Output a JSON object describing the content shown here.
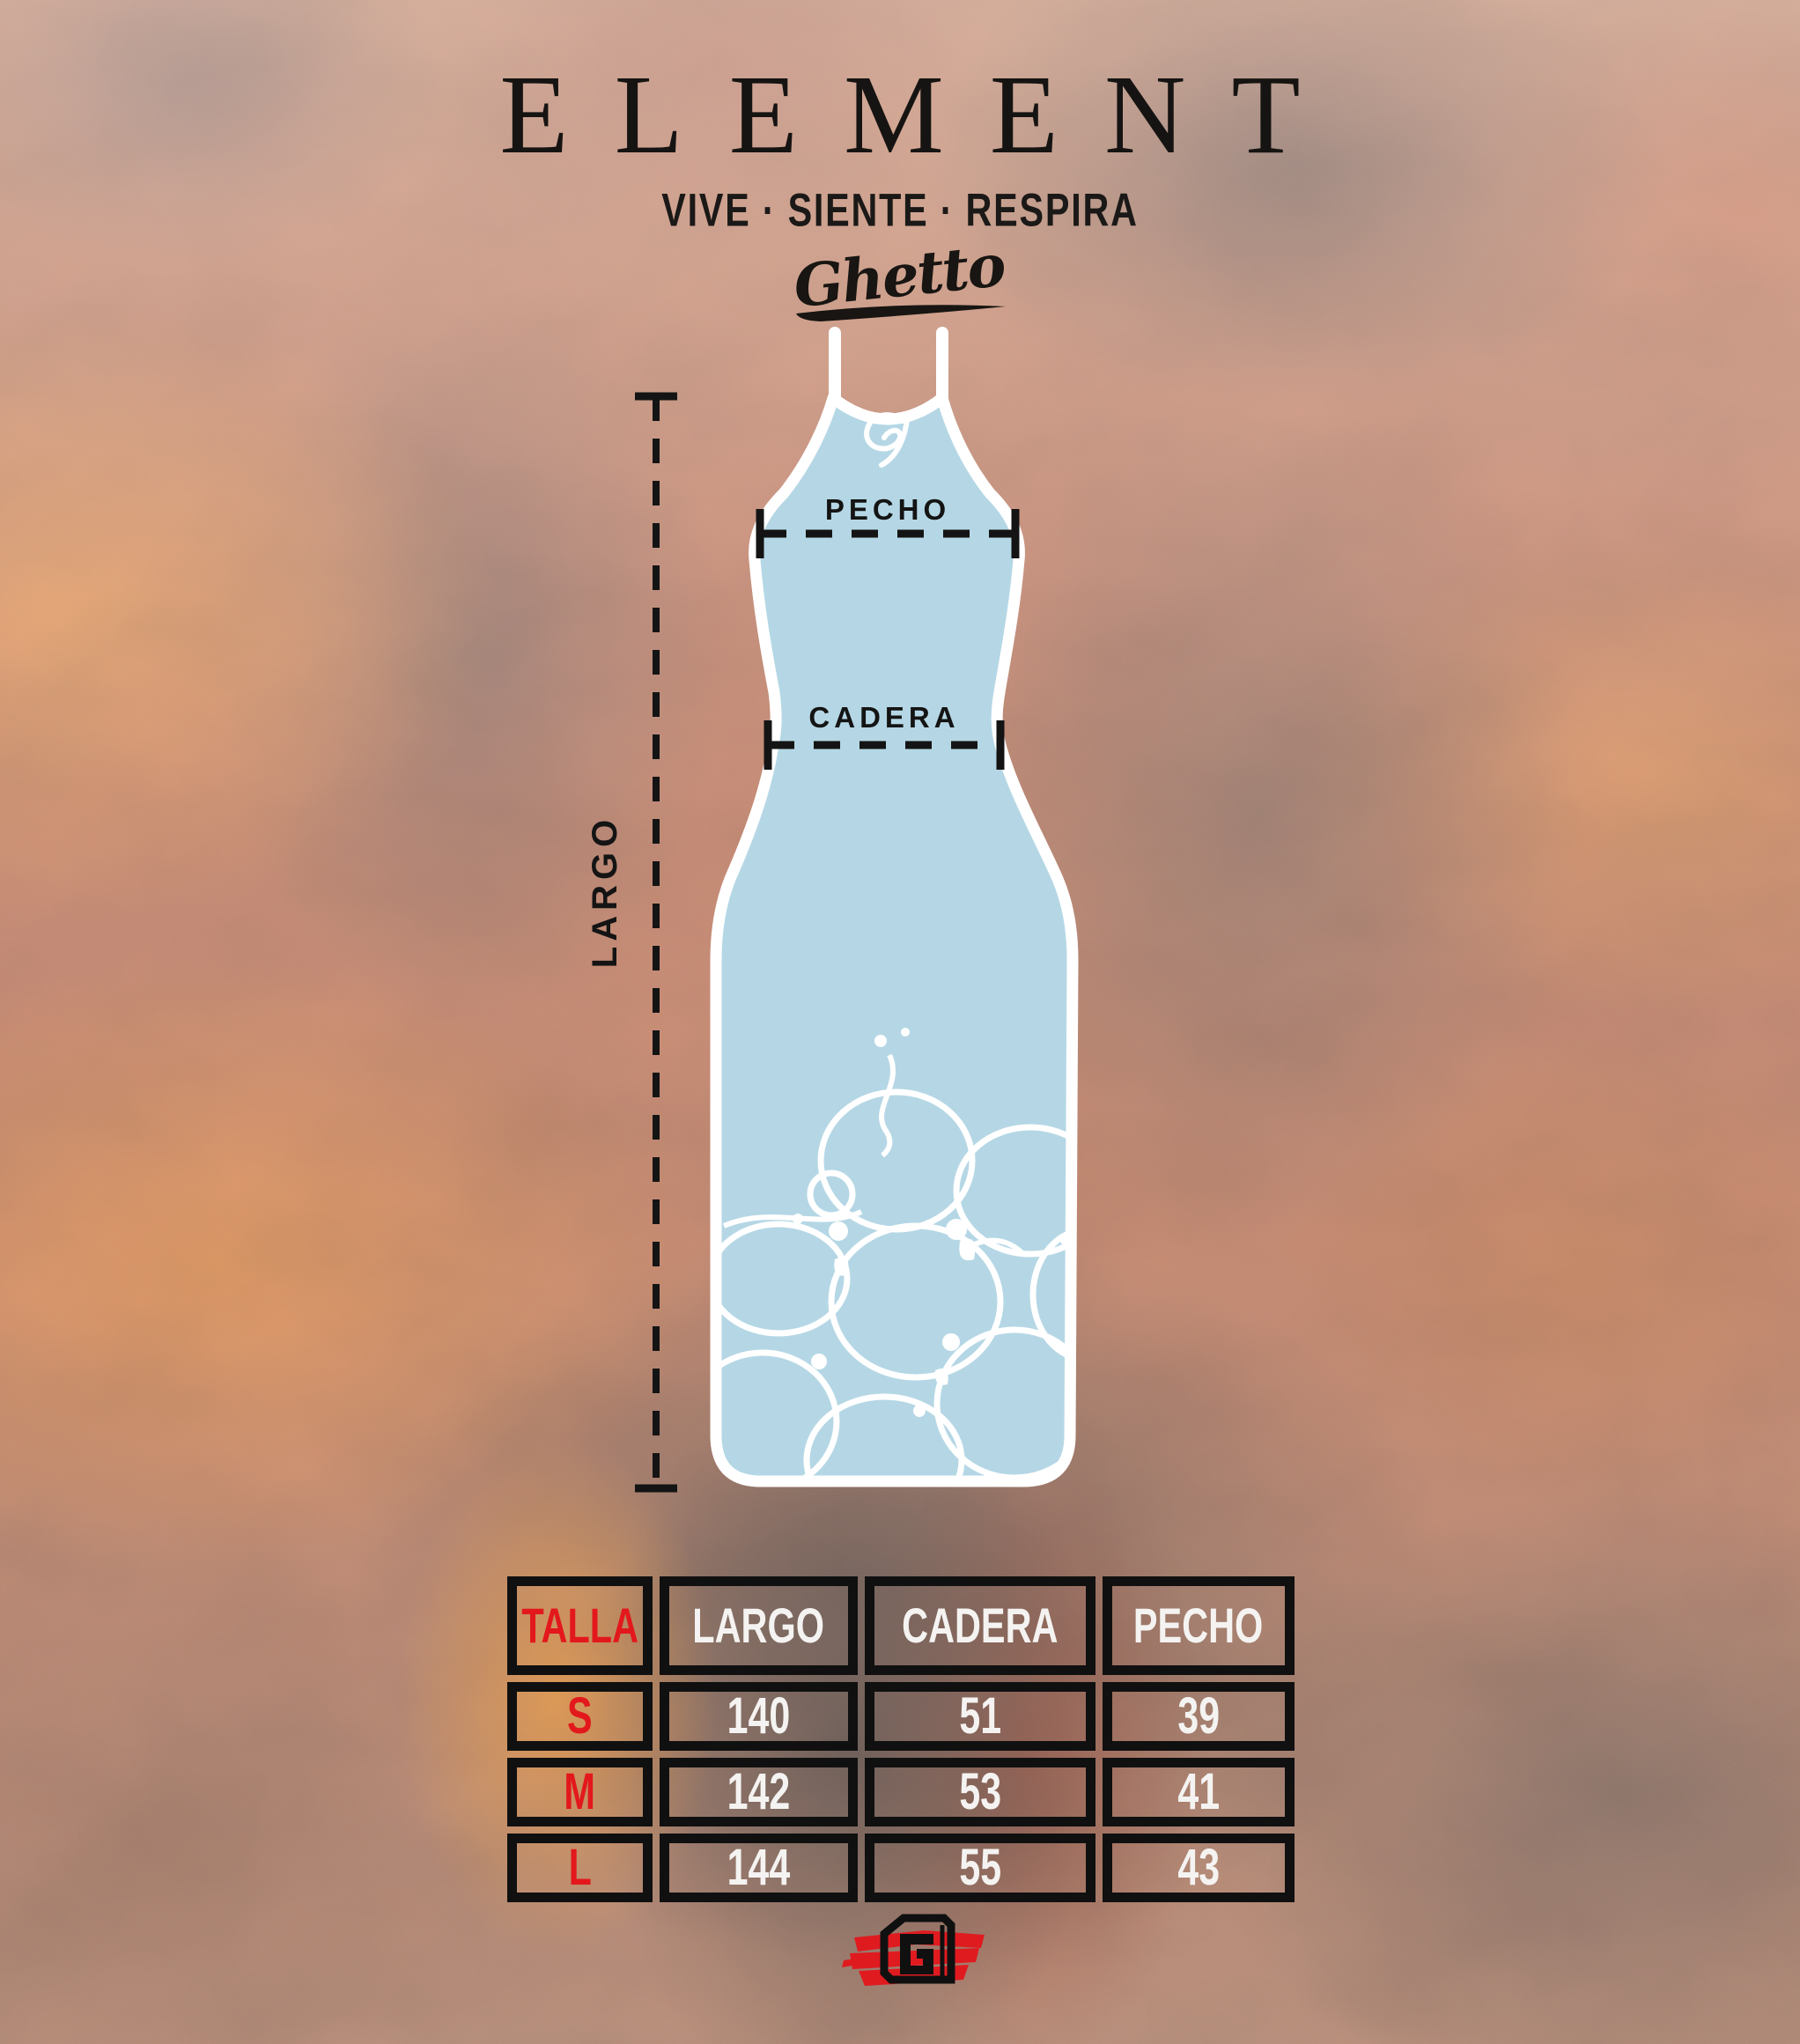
{
  "brand": {
    "name": "ELEMENT",
    "tagline": "VIVE · SIENTE · RESPIRA",
    "script": "Ghetto"
  },
  "garment": {
    "type": "dress-outline",
    "fill_color": "#b5d7e5",
    "outline_color": "#ffffff",
    "chest_logo": "G",
    "pattern": "white-marble-bubbles"
  },
  "measurements": {
    "largo_label": "LARGO",
    "pecho_label": "PECHO",
    "cadera_label": "CADERA"
  },
  "size_table": {
    "columns": [
      "TALLA",
      "LARGO",
      "CADERA",
      "PECHO"
    ],
    "rows": [
      [
        "S",
        "140",
        "51",
        "39"
      ],
      [
        "M",
        "142",
        "53",
        "41"
      ],
      [
        "L",
        "144",
        "55",
        "43"
      ]
    ]
  },
  "footer": {
    "logo_letter": "G"
  },
  "colors": {
    "accent_red": "#e3181c",
    "table_border": "#101010",
    "ink": "#161412",
    "dress_blue": "#b5d7e5"
  }
}
